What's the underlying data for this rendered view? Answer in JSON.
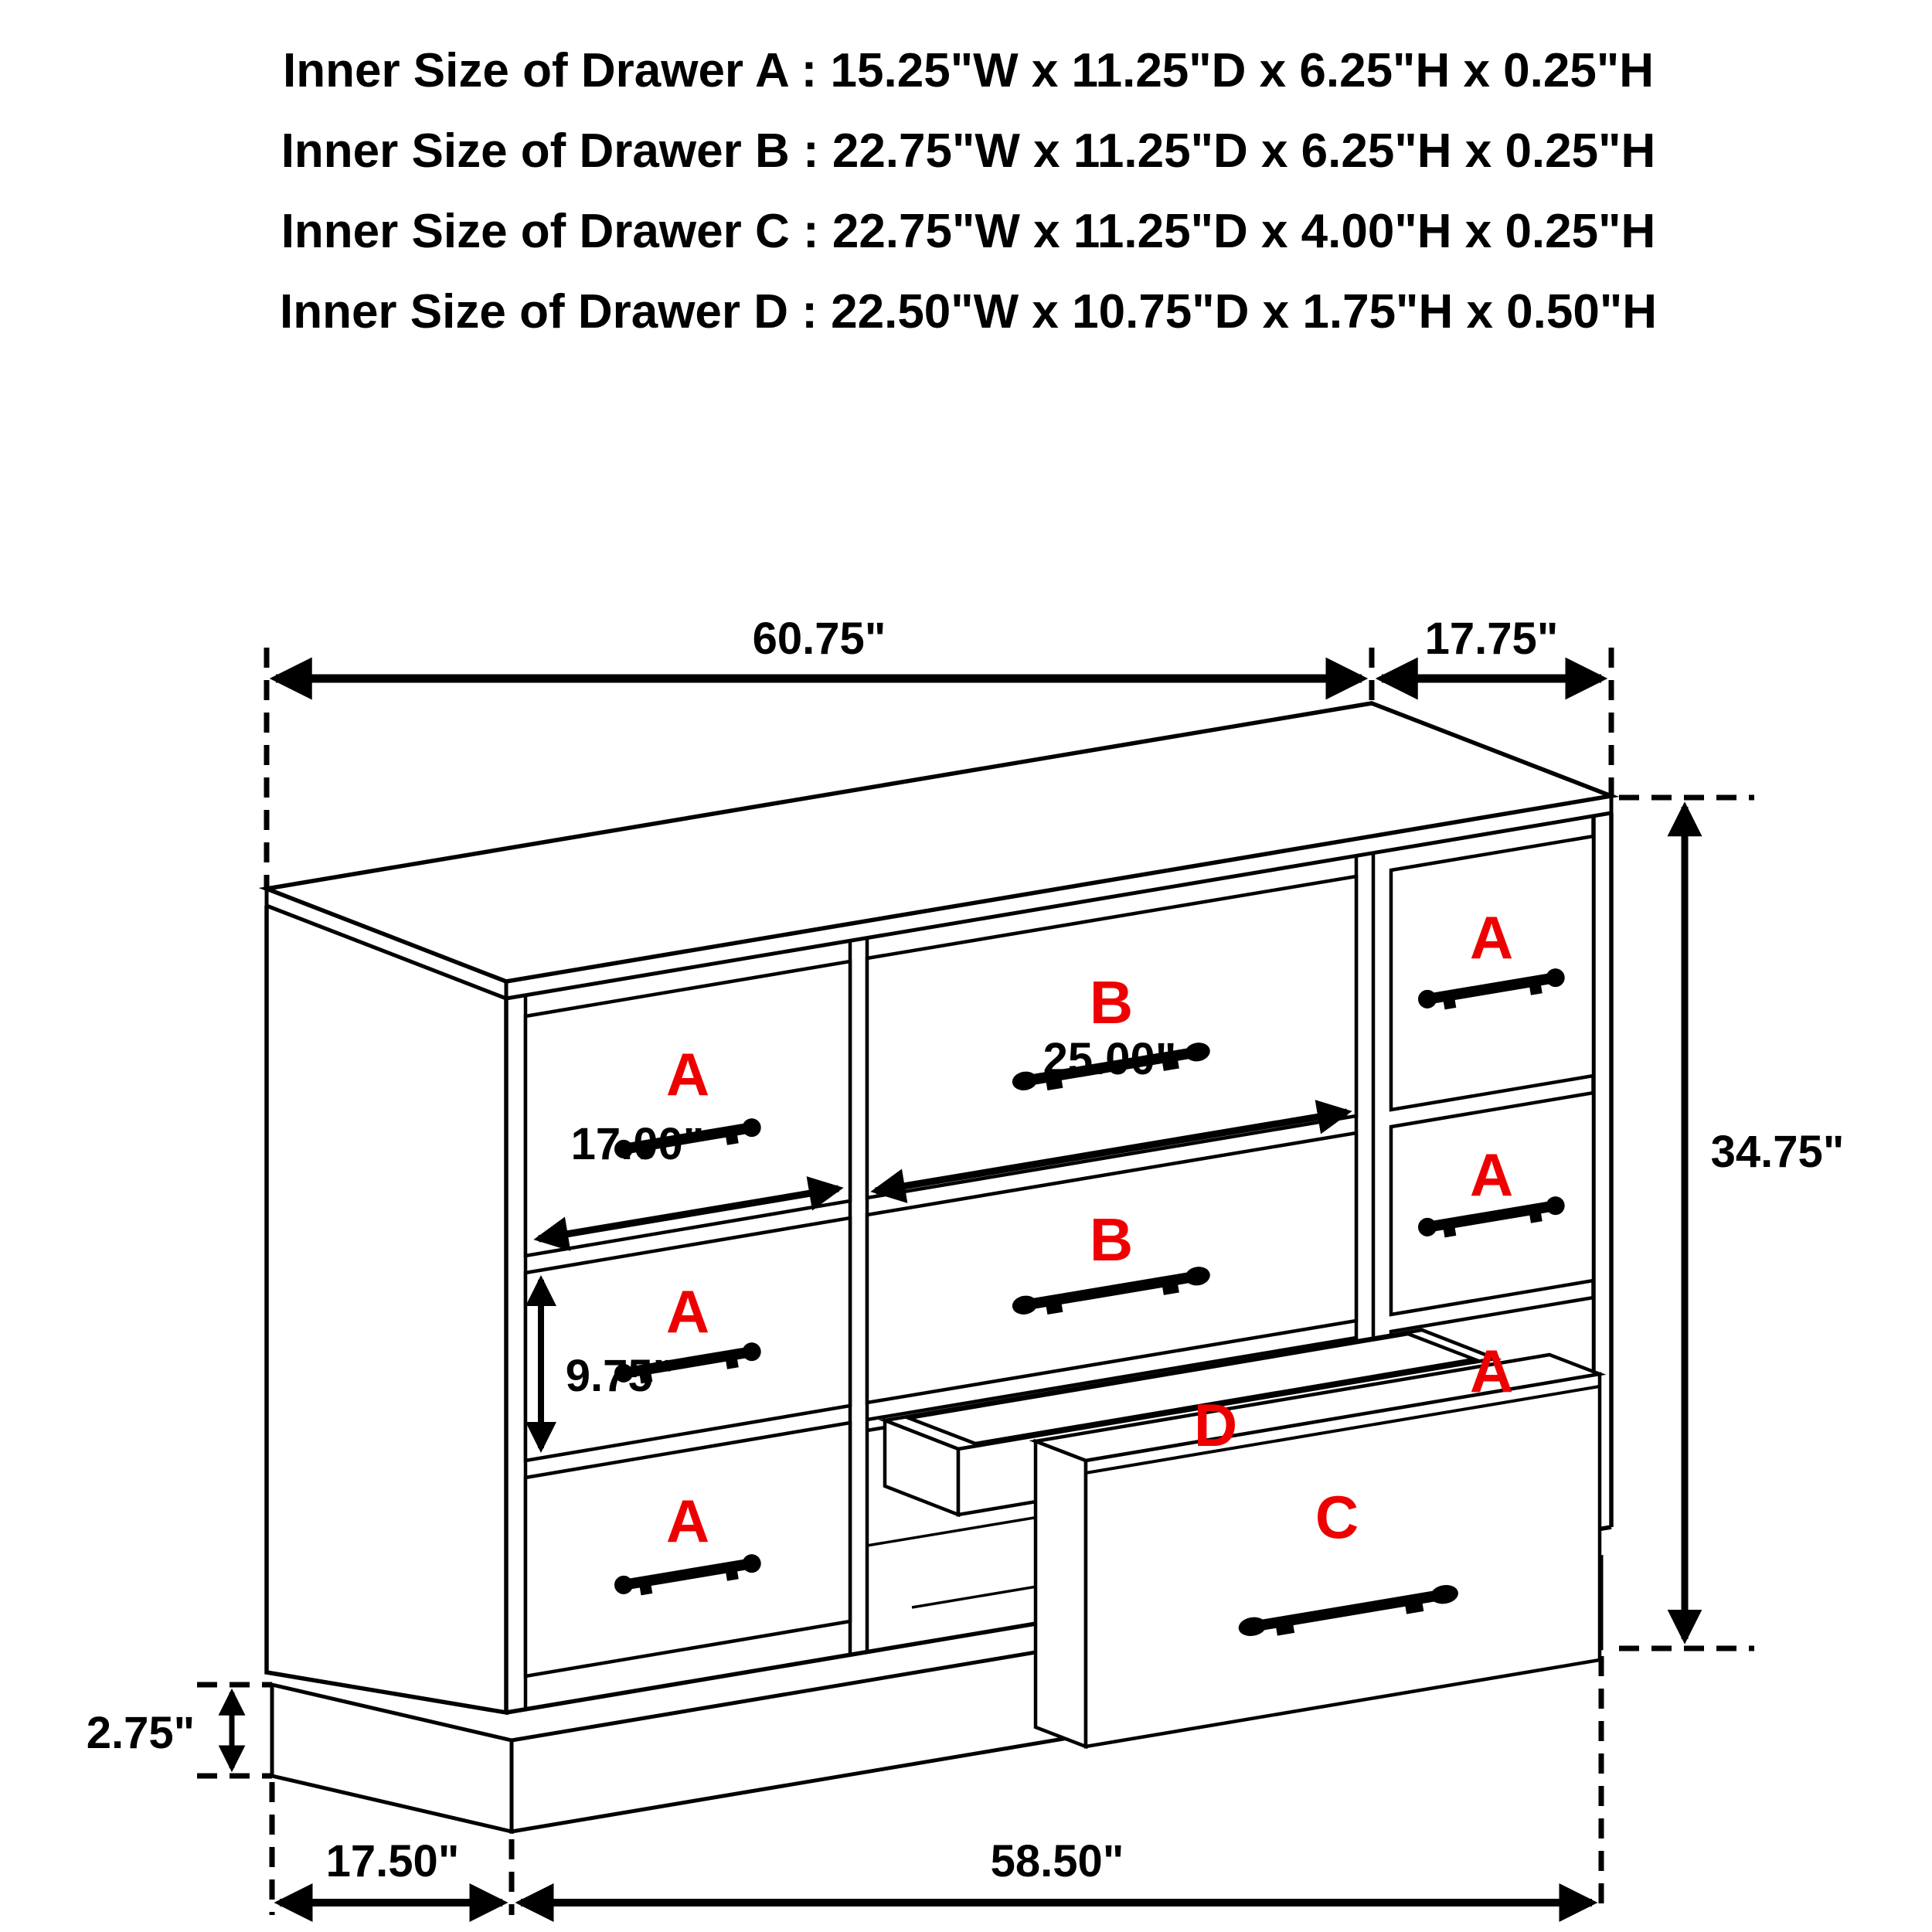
{
  "title_block": {
    "lines": [
      "Inner Size of Drawer A : 15.25\"W x 11.25\"D x 6.25\"H x 0.25\"H",
      "Inner Size of Drawer B : 22.75\"W x 11.25\"D x 6.25\"H x 0.25\"H",
      "Inner Size of Drawer C : 22.75\"W x 11.25\"D x 4.00\"H x 0.25\"H",
      "Inner Size of Drawer  D : 22.50\"W x 10.75\"D x 1.75\"H x 0.50\"H"
    ]
  },
  "dimensions": {
    "top_width": "60.75\"",
    "top_depth": "17.75\"",
    "total_height": "34.75\"",
    "drawer_b_width": "25.00\"",
    "drawer_a_width": "17.00\"",
    "drawer_a_height": "9.75\"",
    "base_height": "2.75\"",
    "base_side_depth": "17.50\"",
    "base_front_width": "58.50\""
  },
  "drawer_labels": {
    "a": "A",
    "b": "B",
    "c": "C",
    "d": "D"
  },
  "colors": {
    "line": "#000000",
    "label_red": "#ee0000",
    "background": "#ffffff"
  }
}
